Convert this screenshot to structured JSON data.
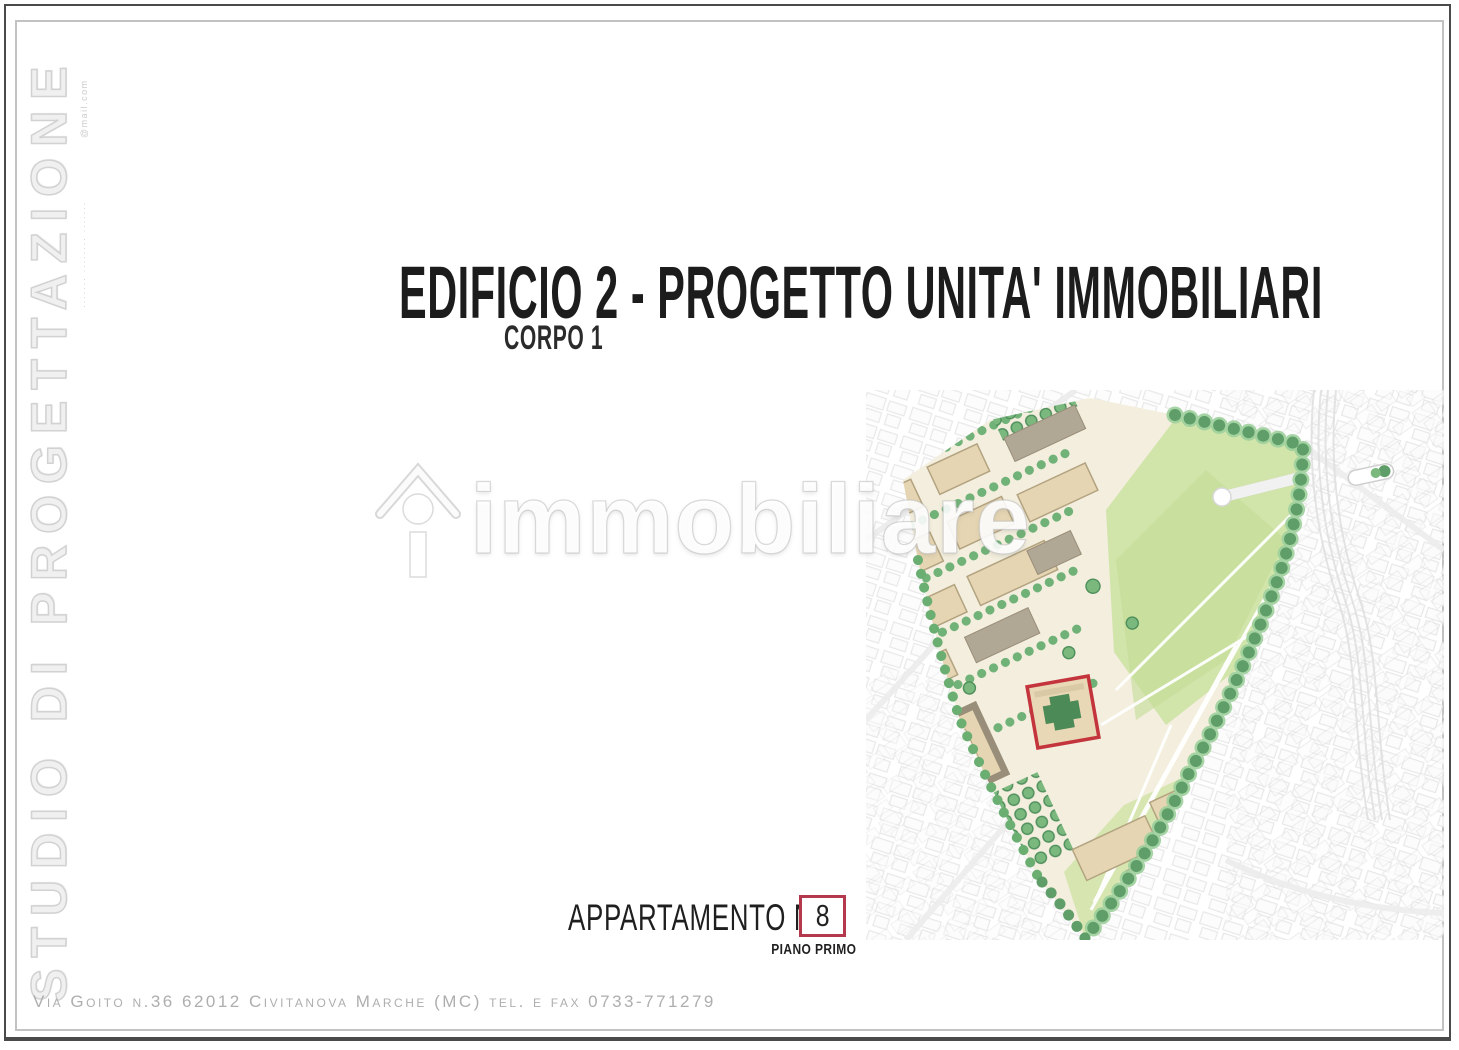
{
  "sidebar": {
    "studio_title": "STUDIO DI PROGETTAZIONE",
    "contact_small_upper": "@mail.com",
    "contact_small_lower": "······· ········ ·······"
  },
  "header": {
    "title": "EDIFICIO 2 - PROGETTO UNITA' IMMOBILIARI",
    "subtitle": "CORPO 1"
  },
  "apartment": {
    "label": "APPARTAMENTO N.",
    "number": "8",
    "floor_label": "PIANO PRIMO"
  },
  "watermark": {
    "brand": "immobiliare"
  },
  "footer": {
    "address": "Via Goito n.36 62012 Civitanova Marche (MC) tel. e fax 0733-771279"
  },
  "colors": {
    "map_highlight_red": "#c4343c",
    "apartment_box_border": "#b5394c",
    "tree_green": "#6aae72",
    "building_tan": "#e5d5b2",
    "park_green": "#cfe3a6"
  }
}
